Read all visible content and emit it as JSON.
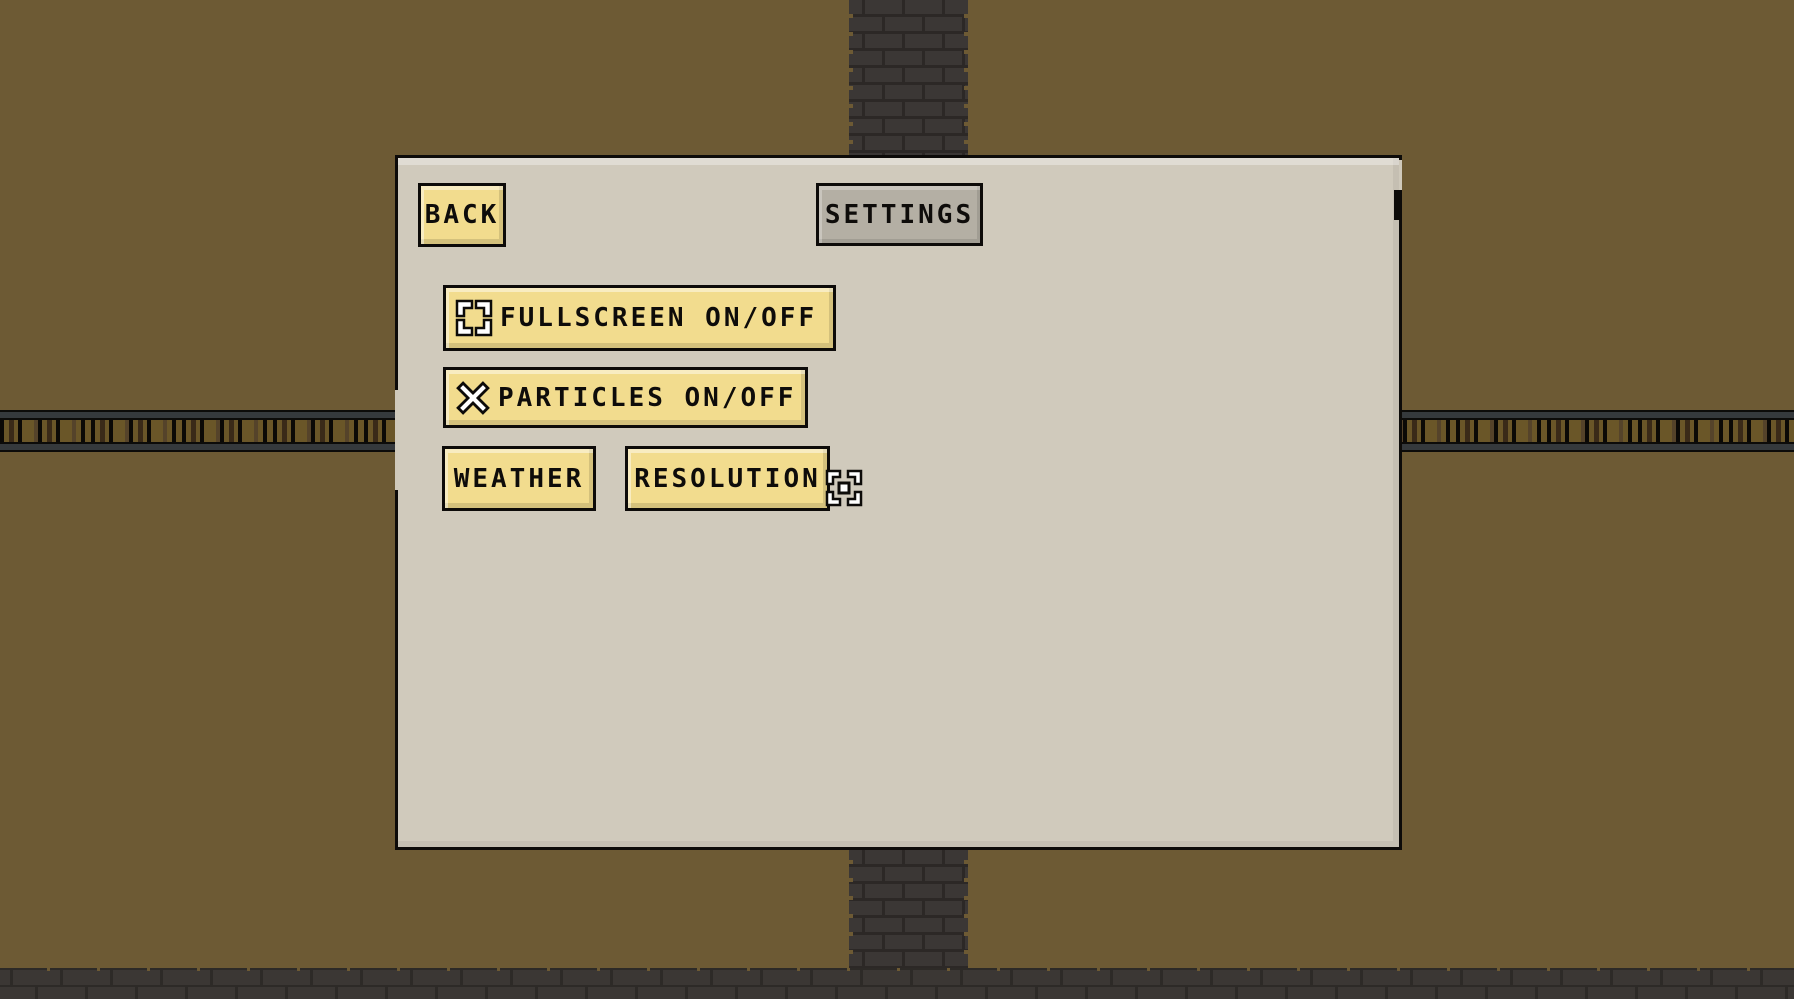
{
  "panel": {
    "back_label": "BACK",
    "title": "SETTINGS",
    "buttons": {
      "fullscreen": "FULLSCREEN ON/OFF",
      "particles": "PARTICLES ON/OFF",
      "weather": "WEATHER",
      "resolution": "RESOLUTION"
    }
  },
  "icons": {
    "fullscreen": "fullscreen-corners-icon",
    "particles": "x-cross-icon",
    "resolution": "resize-viewfinder-icon"
  },
  "colors": {
    "background_brown": "#6d5a34",
    "panel_beige": "#d0cabc",
    "button_yellow": "#f2dc8e",
    "title_gray": "#b4afa4",
    "brick_dark": "#3b3735",
    "mortar_dark": "#2c2826",
    "rail_brown": "#6a5628",
    "rail_metal_gray": "#35393c",
    "text_black": "#0e0c0a"
  }
}
